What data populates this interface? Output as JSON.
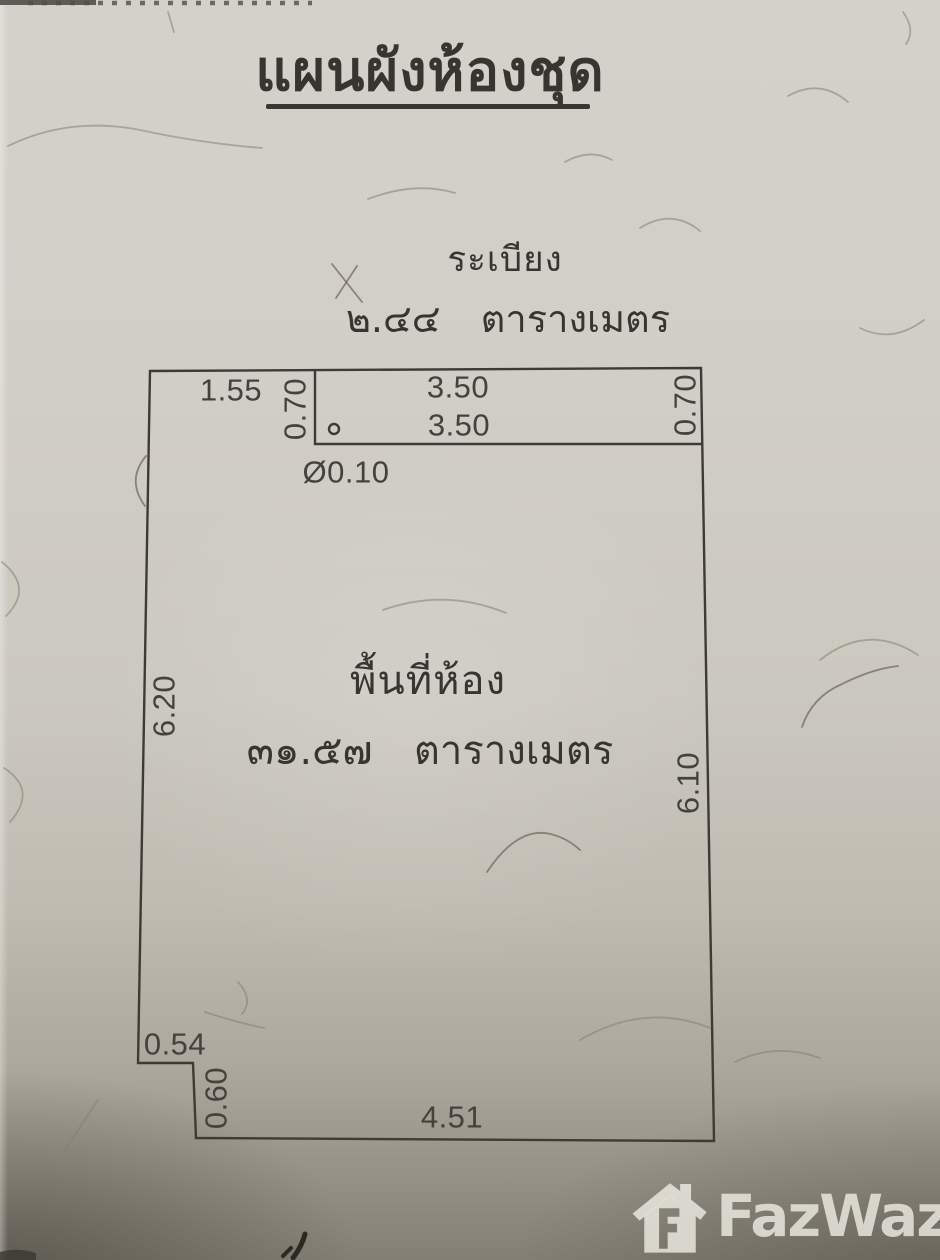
{
  "page": {
    "title": "แผนผังห้องชุด"
  },
  "balcony": {
    "label": "ระเบียง",
    "area": "๒.๔๔  ตารางเมตร"
  },
  "room": {
    "label": "พื้นที่ห้อง",
    "area": "๓๑.๕๗  ตารางเมตร"
  },
  "dims": {
    "top_left_width": "1.55",
    "balcony_depth_left": "0.70",
    "balcony_width_outer": "3.50",
    "balcony_width_inner": "3.50",
    "balcony_depth_right": "0.70",
    "column_diameter": "Ø0.10",
    "wall_left_height": "6.20",
    "wall_right_height": "6.10",
    "notch_width": "0.54",
    "notch_depth": "0.60",
    "wall_bottom_width": "4.51"
  },
  "watermark": {
    "brand": "FazWaz"
  },
  "colors": {
    "ink": "#3c3b36",
    "paper_light": "#d4d1ca",
    "paper_dark": "#837f74",
    "watermark_tint": "#eceae2"
  }
}
